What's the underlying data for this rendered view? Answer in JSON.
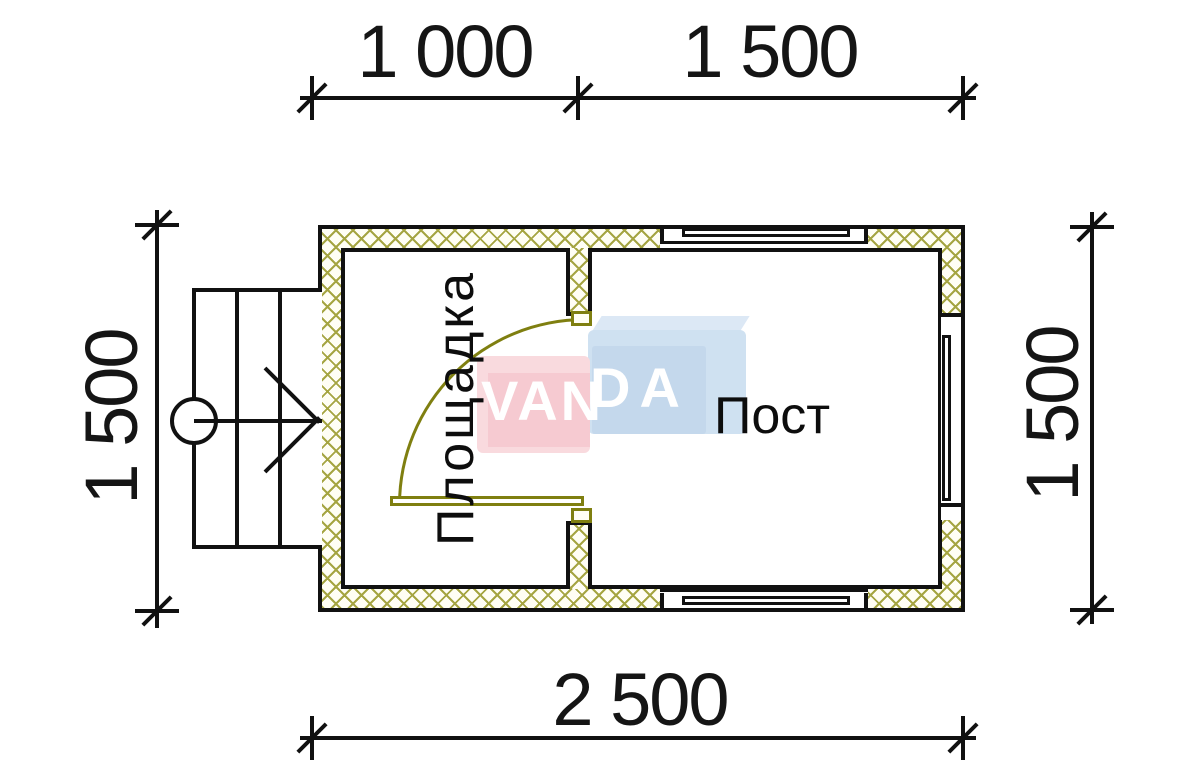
{
  "drawing": {
    "type": "architectural-floor-plan",
    "units": "mm"
  },
  "dimensions": {
    "top": [
      {
        "label": "1 000"
      },
      {
        "label": "1 500"
      }
    ],
    "bottom": {
      "label": "2 500"
    },
    "left": {
      "label": "1 500"
    },
    "right": {
      "label": "1 500"
    }
  },
  "rooms": [
    {
      "name": "Площадка"
    },
    {
      "name": "Пост"
    }
  ],
  "watermark": {
    "full": "VANDA",
    "part1": "VAN",
    "part2": "DA"
  },
  "colors": {
    "line": "#111111",
    "wall_hatch": "#a5a542",
    "door": "#7f7f10",
    "watermark_pink": "#f6cad1",
    "watermark_blue": "#cfe1f1",
    "background": "#ffffff"
  }
}
